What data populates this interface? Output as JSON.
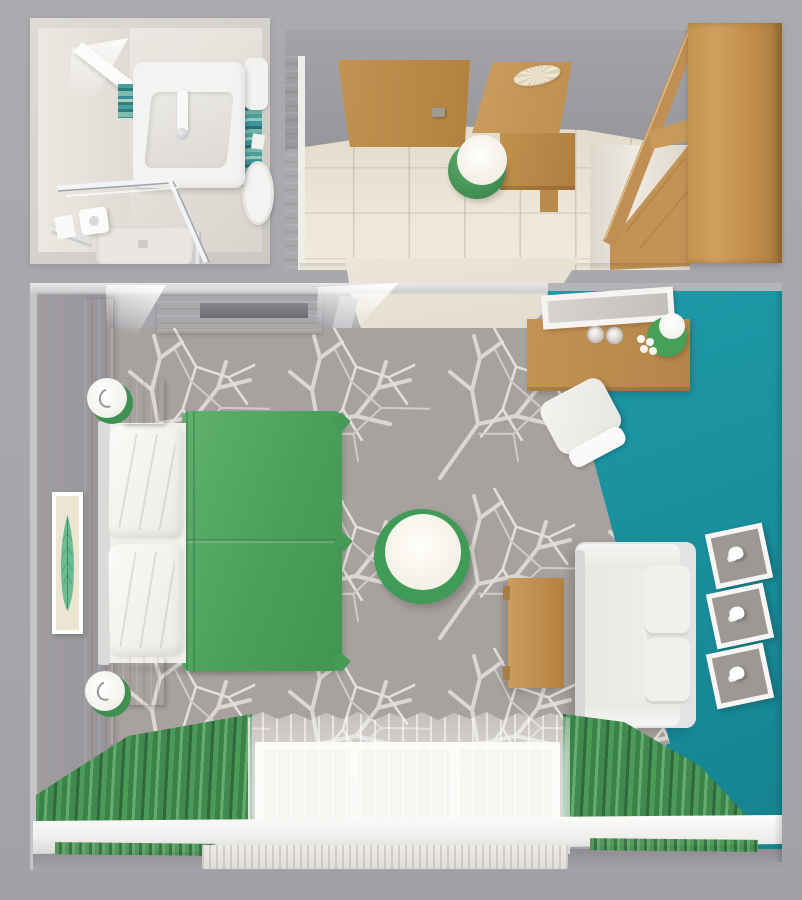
{
  "scene": {
    "title": "Top-down 3D render of a studio suite floor plan",
    "palette": {
      "background_gray": "#a8a8ac",
      "teal_accent": "#1b95a3",
      "wood": "#c2914f",
      "duvet_green": "#4da25d",
      "curtain_green": "#3f8a4e",
      "rug_gray": "#a7a29f",
      "rug_pattern_white": "#dcd9d6",
      "floor_beige": "#e8e2d4",
      "white_furniture": "#f4f3f1"
    },
    "rooms": {
      "bathroom": {
        "label": "Bathroom",
        "items": {
          "sink": "Washbasin vanity with faucet",
          "mirror": "Mirror shelf",
          "mosaic": "Teal mosaic tile band",
          "cistern": "Toilet cistern",
          "bowl": "Toilet bowl",
          "shower": "Glass shower enclosure",
          "shower_head": "Shower head",
          "tray": "Shower tray",
          "towel_rail": "Towel rail with towel"
        }
      },
      "entry": {
        "label": "Entry hall",
        "items": {
          "door": "Entrance door",
          "handle": "Door handle",
          "ceiling_light": "Pleated ceiling light",
          "desk_panel": "Desk wall panel",
          "desk": "Desk",
          "stool": "Stool with green base and white seat",
          "wardrobe": "Wardrobe cabinet",
          "floor": "Beige tile floor",
          "corridor": "Corridor to main room"
        }
      },
      "main": {
        "label": "Bedroom / living room",
        "items": {
          "accent_wall": "Teal accent wall",
          "rug": "Gray rug with white branch pattern",
          "tv_panel": "Wooden TV valance",
          "tv": "Wall-mounted TV",
          "headboard": "Wooden headboard panel",
          "art": "Framed leaf artwork",
          "bed": "Double bed",
          "pillows": "White pillows",
          "duvet": "Green duvet",
          "nightstand_top": "Nightstand (top)",
          "nightstand_bottom": "Nightstand (bottom)",
          "lamp_top": "Bedside lamp (top)",
          "lamp_bottom": "Bedside lamp (bottom)",
          "round_table": "Round table with green rim",
          "console": "Wooden console / vanity",
          "mirror": "Leaning mirror",
          "glasses": "Two glasses",
          "console_lamp": "Green table lamp with flowers",
          "chair": "White chair",
          "coffee_table": "Wooden coffee table",
          "sofa": "White two-seat sofa",
          "niches": "Three white wall niches with decor",
          "window": "Window wall",
          "curtain_left": "Green curtain (left)",
          "curtain_right": "Green curtain (right)",
          "sheer": "Sheer white curtain",
          "sill": "White window sill"
        }
      }
    }
  }
}
